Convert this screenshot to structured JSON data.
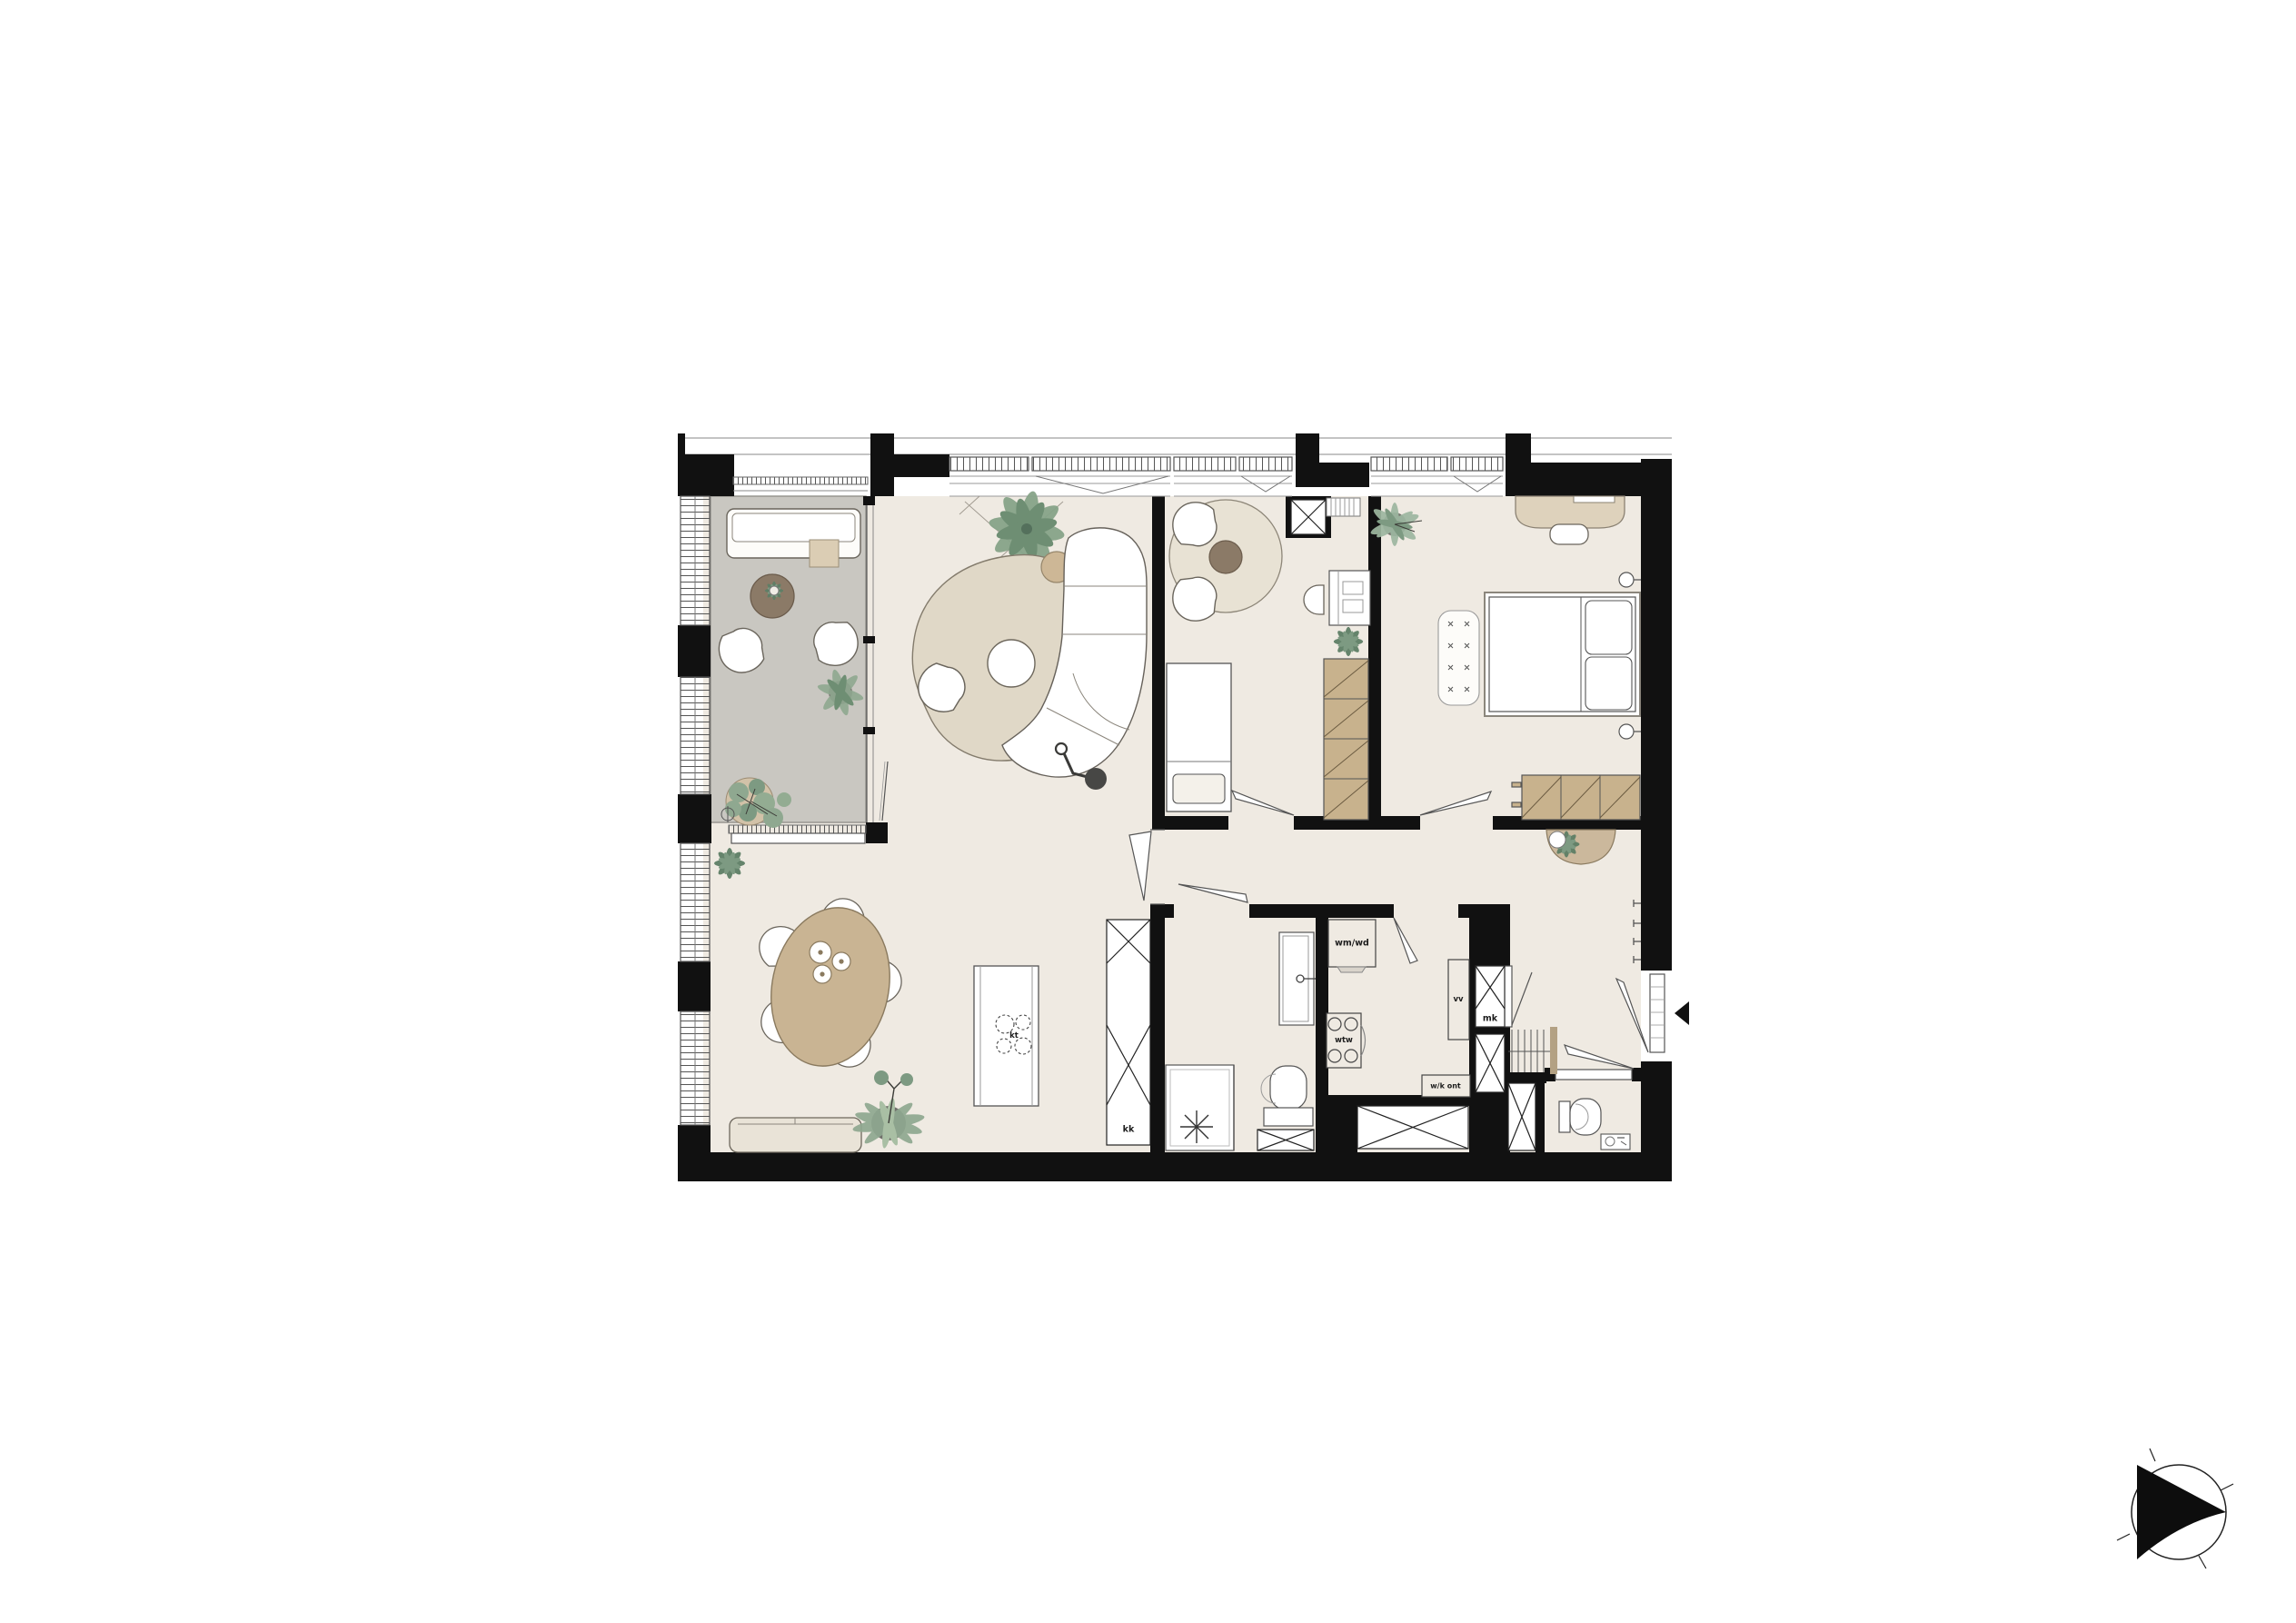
{
  "title": "apartment-floor-plan",
  "labels": {
    "wm_wd": "wm/wd",
    "wtw": "wtw",
    "vv": "vv",
    "mk": "mk",
    "wk_ont": "w/k ont",
    "kk": "kk",
    "kt": "kt"
  },
  "compass": {
    "type": "north-arrow",
    "pointing": "right"
  },
  "entrance": {
    "marker": "black-triangle",
    "side": "right-wall"
  },
  "colors": {
    "wall": "#111111",
    "floor": "#efeae2",
    "loggia_floor": "#c9c7c1",
    "rug": "#e0d8c7",
    "round_rug": "#e8e2d4",
    "wood_tan": "#c9b493",
    "wardrobe": "#c8b28d",
    "dark_table": "#8b7a67",
    "plant_green": "#8fa890",
    "plant_dark": "#6e8e73",
    "lamp_dark": "#474745"
  }
}
